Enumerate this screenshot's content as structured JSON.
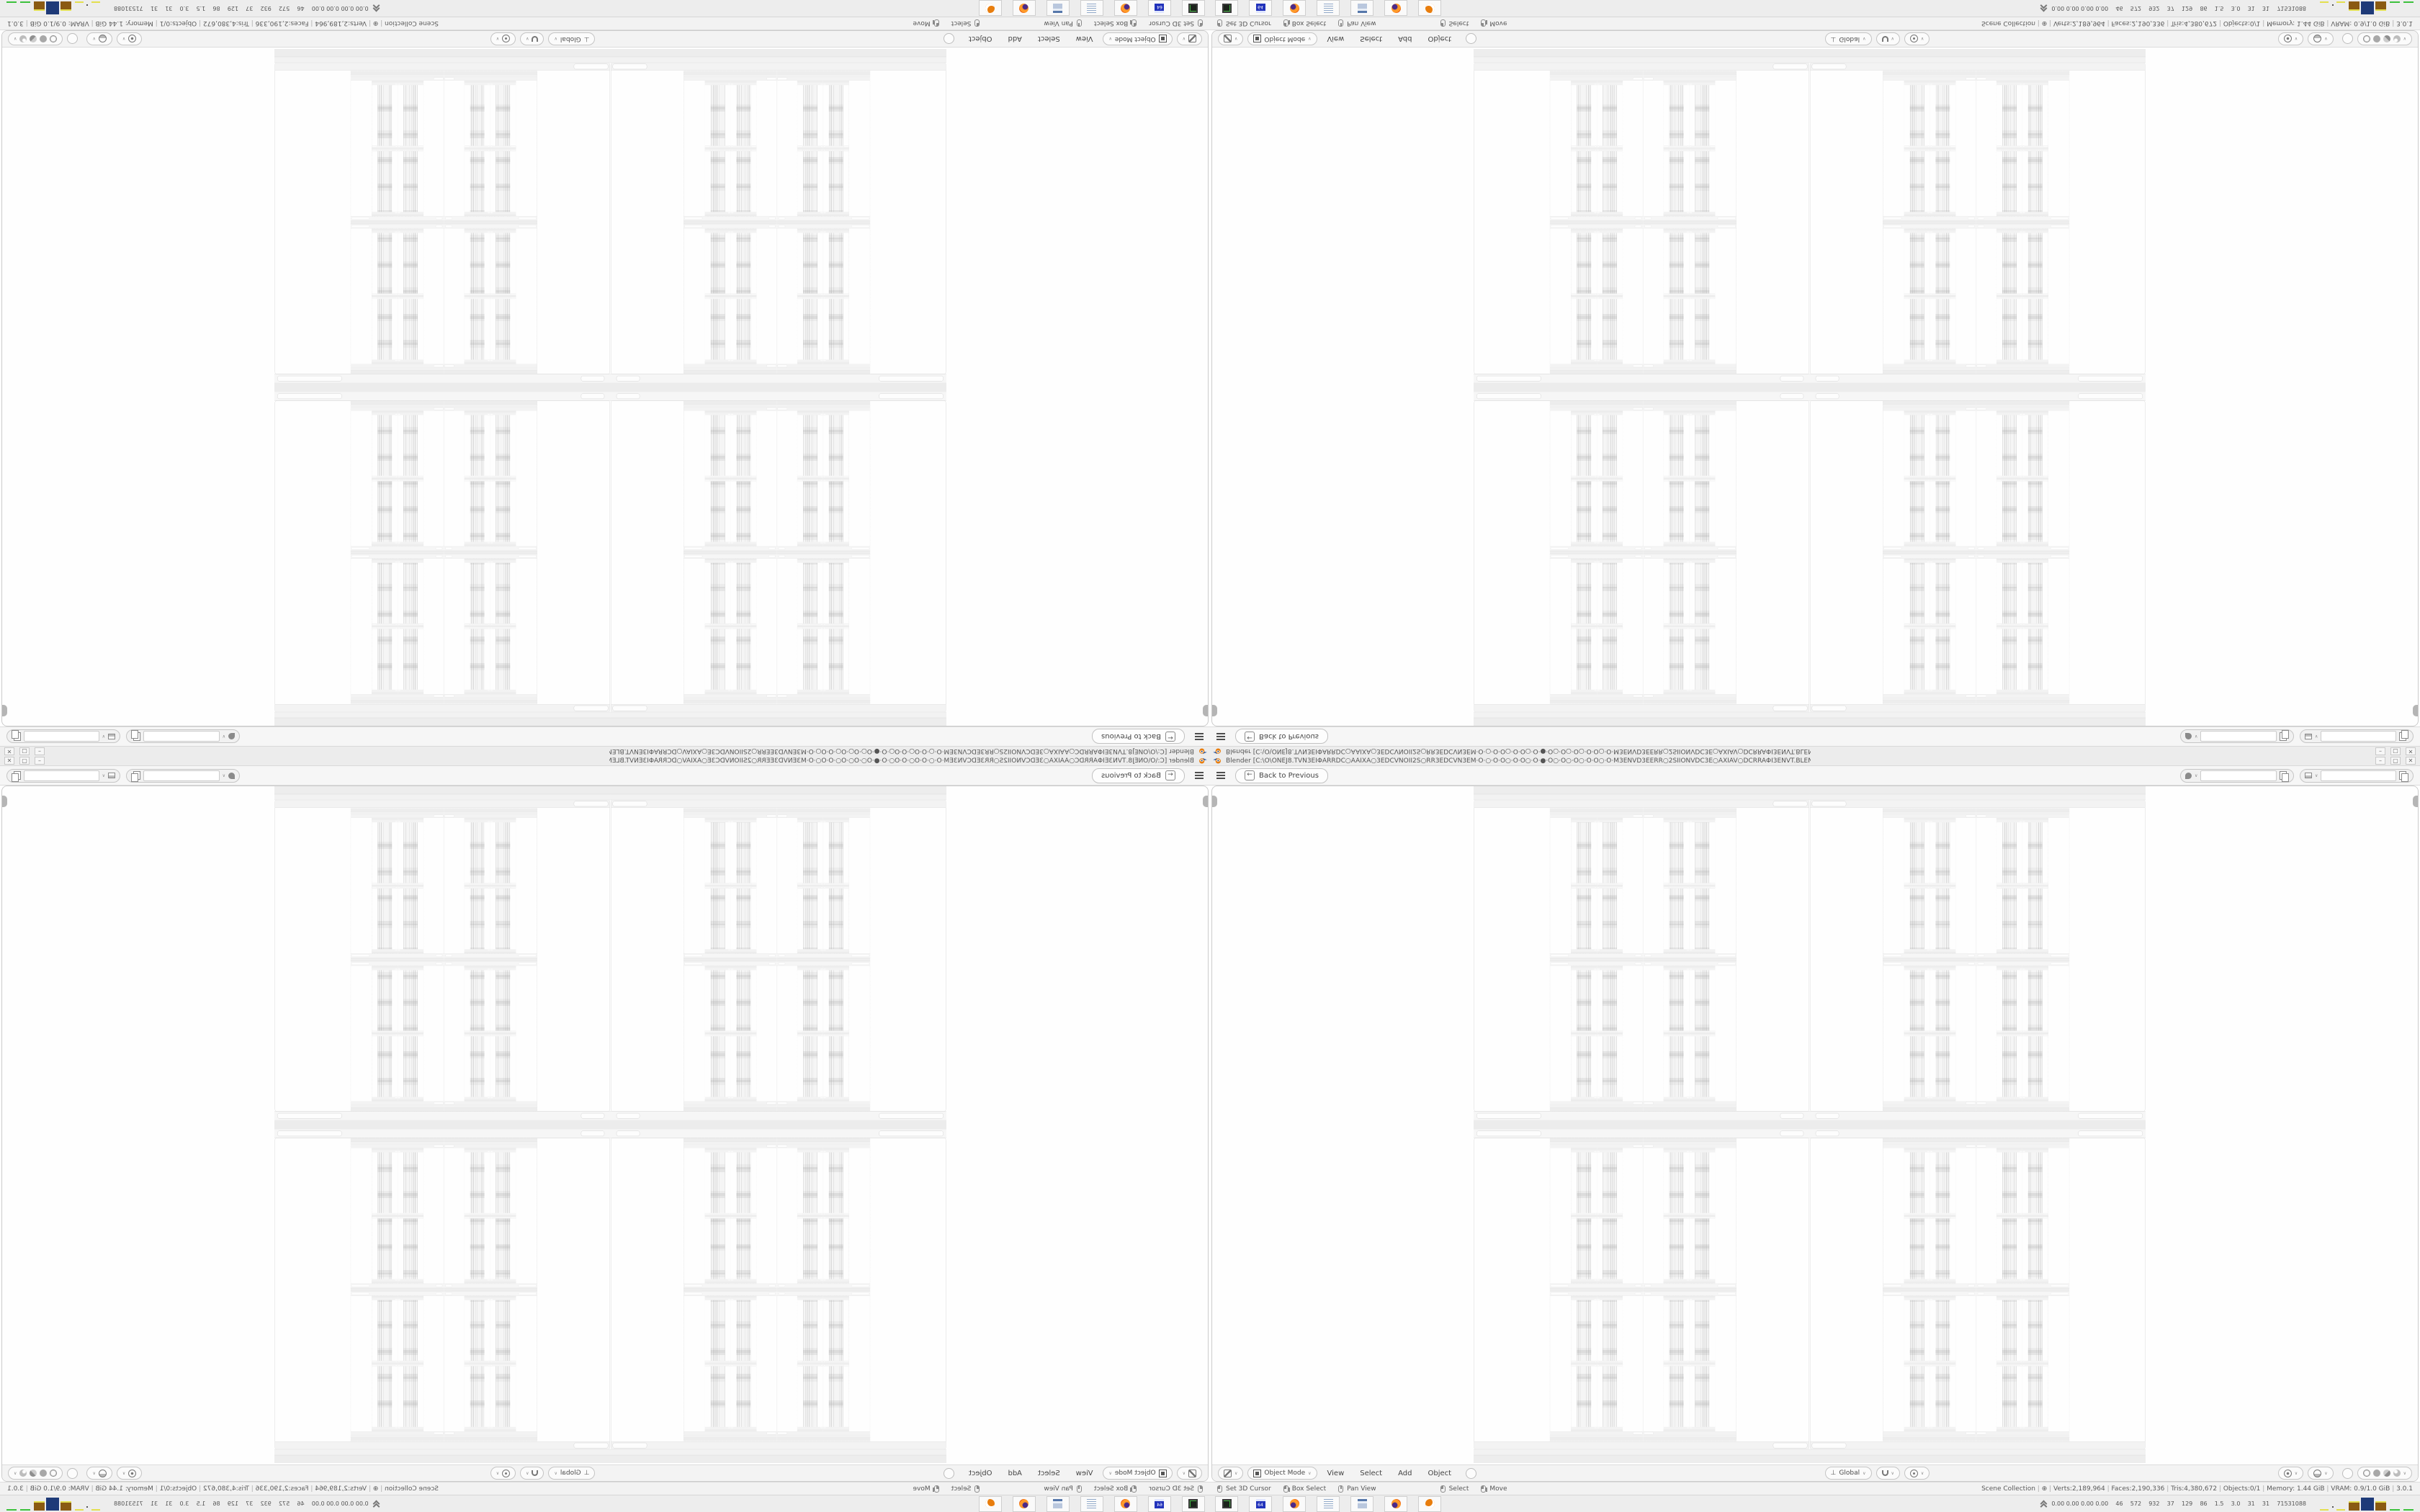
{
  "window": {
    "title": "Blender [C:\\O\\ONEJ8.TVN3EIΦARRDC○AAIXA○3EDCVNOII2S○RR3EDCVN3EM·O·○·O·O○·O·O○·O·●·O○·O○·O○·O·O○·O·M3ENVD3EERR○2SIIONVDC3E○AXIAV○DCRRAΦI3ENVT.BLEND]",
    "minimize_glyph": "–",
    "restore_glyph": "▢",
    "close_glyph": "✕"
  },
  "topbar": {
    "back_label": "Back to Previous"
  },
  "header": {
    "mode": "Object Mode",
    "menus": [
      "View",
      "Select",
      "Add",
      "Object"
    ],
    "orientation": "Global"
  },
  "status": {
    "hints": [
      "Set 3D Cursor",
      "Box Select",
      "Pan View",
      "Select",
      "Move"
    ],
    "info": [
      "Scene Collection",
      "⊕",
      "Verts:2,189,964",
      "Faces:2,190,336",
      "Tris:4,380,672",
      "Objects:0/1",
      "Memory: 1.44 GiB",
      "VRAM: 0.9/1.0 GiB",
      "3.0.1"
    ]
  },
  "taskbar": {
    "stats": "0.00 0.00 0.00 0.00    46    572    932    37    129    86    1.5    3.0    31    31    71531088",
    "launchers": [
      "terminal",
      "floppy-64",
      "firefox",
      "notepad",
      "calculator",
      "firefox",
      "blender"
    ]
  },
  "colors": {
    "accent": "#e87d0d",
    "tray_yellow": "#e3df4f",
    "tray_brown": "#8a5a12",
    "tray_blue": "#1e3a78",
    "tray_green": "#3cc13c"
  }
}
